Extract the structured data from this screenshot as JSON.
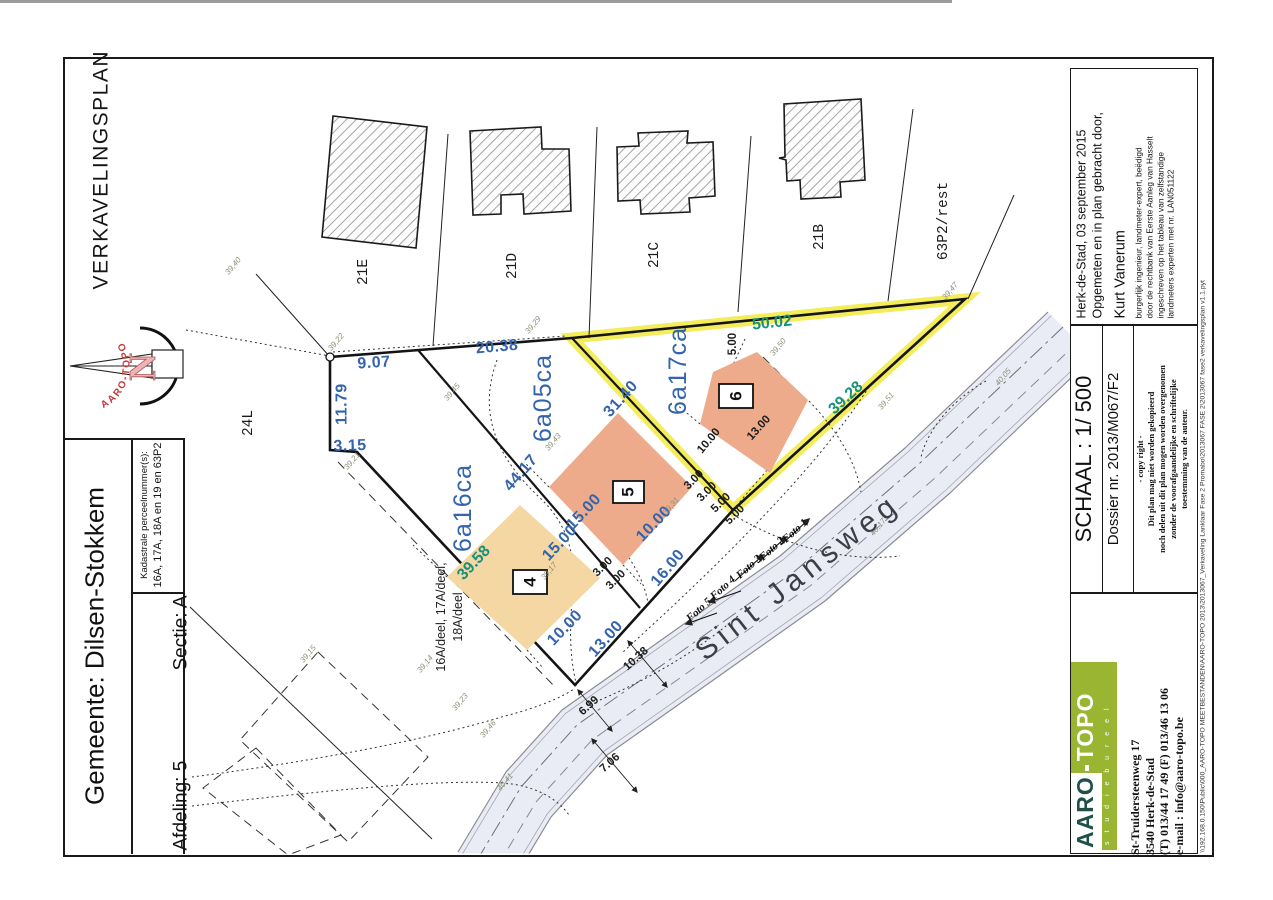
{
  "document": {
    "plan_type": "VERKAVELINGSPLAN",
    "file_path": "\\\\192.168.0.150\\Public\\000_AARO-TOPO MEETBESTANDEN\\AARO-TOPO 2013\\2013067_Verkaveling Lanklaar Fase 2 Promabo\\2013067 FASE 2\\2013067 fase2 verkavelingsplan v1.1.pyt"
  },
  "title_block": {
    "gemeente": "Gemeente: Dilsen-Stokkem",
    "afdeling": "Afdeling: 5",
    "sectie": "Sectie: A",
    "kadastrale_label": "Kadastrale perceelnummer(s):",
    "kadastrale_value": "16A, 17A, 18A en 19 en 63P2"
  },
  "survey_block": {
    "place_date": "Herk-de-Stad, 03 september 2015",
    "intro": "Opgemeten en in plan gebracht door,",
    "surveyor": "Kurt Vanerum",
    "credentials": [
      "burgerlijk ingenieur,  landmeter-expert,  beëdigd",
      "door de rechtbank van Eerste Aanleg van Hasselt",
      "ingeschreven op het tableau van zelfstandige",
      "landmeters experten met nr. LAN051122"
    ]
  },
  "scale_block": {
    "schaal": "SCHAAL : 1/ 500",
    "dossier": "Dossier nr. 2013/M067/F2",
    "copyright": [
      "- copy right -",
      "Dit plan mag niet worden gekopieerd",
      "noch delen uit dit plan mogen worden overgenomen",
      "zonder de voorafgaandelijke en schriftelijke",
      "toestemming van de auteur."
    ]
  },
  "firm_block": {
    "brand_left": "AARO",
    "brand_right": "TOPO",
    "brand_sub": "s t u d i e b u r e e l",
    "address": [
      "St-Truidersteenweg 17",
      "3540 Herk-de-Stad",
      "(T) 013/44 17 49  (F) 013/46 13 06",
      "e-mail : info@aaro-topo.be"
    ]
  },
  "compass": {
    "north": "N",
    "brand": "AARO-TOPO"
  },
  "colors": {
    "dim_blue": "#3465ac",
    "dim_teal": "#17917c",
    "lot_tan": "#f4d7a2",
    "lot_salmon": "#eeab8b",
    "highlight_yellow": "#f2ea3e",
    "road_fill": "#e9ecf5",
    "logo_green": "#9ab531",
    "logo_dark": "#20504a"
  },
  "plan": {
    "street_name": "Sint Jansweg",
    "lots": [
      {
        "nr": "4",
        "area": "6a16ca"
      },
      {
        "nr": "5",
        "area": "6a05ca"
      },
      {
        "nr": "6",
        "area": "6a17ca"
      }
    ],
    "neighbour_parcels": [
      "24L",
      "21E",
      "21D",
      "21C",
      "21B",
      "63P2/rest"
    ],
    "origin_parcels": "16A/deel, 17A/deel, 18A/deel",
    "labels": [
      {
        "t": "9.07",
        "x": 374,
        "y": 363,
        "r": -4,
        "k": "dim"
      },
      {
        "t": "20.38",
        "x": 497,
        "y": 347,
        "r": -5,
        "k": "dim"
      },
      {
        "t": "11.79",
        "x": 342,
        "y": 404,
        "r": -90,
        "k": "dim"
      },
      {
        "t": "3.15",
        "x": 350,
        "y": 446,
        "r": -2,
        "k": "dim"
      },
      {
        "t": "31.40",
        "x": 621,
        "y": 399,
        "r": -48,
        "k": "dim"
      },
      {
        "t": "44.17",
        "x": 521,
        "y": 473,
        "r": -49,
        "k": "dim"
      },
      {
        "t": "15.00",
        "x": 560,
        "y": 543,
        "r": -47,
        "k": "dim"
      },
      {
        "t": "10.00",
        "x": 565,
        "y": 628,
        "r": -46,
        "k": "dim"
      },
      {
        "t": "15.00",
        "x": 584,
        "y": 512,
        "r": -47,
        "k": "dim"
      },
      {
        "t": "10.00",
        "x": 654,
        "y": 524,
        "r": -46,
        "k": "dim"
      },
      {
        "t": "16.00",
        "x": 668,
        "y": 568,
        "r": -50,
        "k": "dim"
      },
      {
        "t": "13.00",
        "x": 606,
        "y": 639,
        "r": -48,
        "k": "dim"
      },
      {
        "t": "50.02",
        "x": 772,
        "y": 323,
        "r": -6,
        "k": "teal"
      },
      {
        "t": "39.28",
        "x": 846,
        "y": 398,
        "r": -43,
        "k": "teal"
      },
      {
        "t": "39.58",
        "x": 474,
        "y": 563,
        "r": -47,
        "k": "teal"
      },
      {
        "t": "3.00",
        "x": 603,
        "y": 567,
        "r": -45,
        "k": "dimk"
      },
      {
        "t": "3.00",
        "x": 616,
        "y": 580,
        "r": -45,
        "k": "dimk"
      },
      {
        "t": "3.00",
        "x": 694,
        "y": 480,
        "r": -45,
        "k": "dimk"
      },
      {
        "t": "3.00",
        "x": 707,
        "y": 492,
        "r": -45,
        "k": "dimk"
      },
      {
        "t": "5.00",
        "x": 721,
        "y": 503,
        "r": -45,
        "k": "dimk"
      },
      {
        "t": "5.00",
        "x": 735,
        "y": 515,
        "r": -45,
        "k": "dimk"
      },
      {
        "t": "5.00",
        "x": 733,
        "y": 344,
        "r": -90,
        "k": "dimk"
      },
      {
        "t": "10.00",
        "x": 709,
        "y": 441,
        "r": -50,
        "k": "dimk"
      },
      {
        "t": "13.00",
        "x": 759,
        "y": 428,
        "r": -48,
        "k": "dimk"
      },
      {
        "t": "10.38",
        "x": 636,
        "y": 659,
        "r": -42,
        "k": "dimk"
      },
      {
        "t": "6.99",
        "x": 589,
        "y": 706,
        "r": -42,
        "k": "dimk"
      },
      {
        "t": "7.06",
        "x": 610,
        "y": 763,
        "r": -42,
        "k": "dimk"
      },
      {
        "t": "6a16ca",
        "x": 463,
        "y": 508,
        "r": -90,
        "k": "area"
      },
      {
        "t": "6a05ca",
        "x": 543,
        "y": 398,
        "r": -90,
        "k": "area"
      },
      {
        "t": "6a17ca",
        "x": 678,
        "y": 371,
        "r": -90,
        "k": "area"
      },
      {
        "t": "24L",
        "x": 249,
        "y": 423,
        "r": -90,
        "k": "parcel"
      },
      {
        "t": "21E",
        "x": 364,
        "y": 272,
        "r": -90,
        "k": "parcel"
      },
      {
        "t": "21D",
        "x": 513,
        "y": 266,
        "r": -90,
        "k": "parcel"
      },
      {
        "t": "21C",
        "x": 655,
        "y": 255,
        "r": -90,
        "k": "parcel"
      },
      {
        "t": "21B",
        "x": 820,
        "y": 237,
        "r": -90,
        "k": "parcel"
      },
      {
        "t": "63P2/rest",
        "x": 944,
        "y": 221,
        "r": -90,
        "k": "parcel"
      },
      {
        "t": "16A/deel, 17A/deel,",
        "x": 441,
        "y": 617,
        "r": -90,
        "k": "deel"
      },
      {
        "t": "18A/deel",
        "x": 458,
        "y": 617,
        "r": -90,
        "k": "deel"
      },
      {
        "t": "4",
        "x": 530,
        "y": 582,
        "r": -90,
        "k": "lotnr"
      },
      {
        "t": "5",
        "x": 628,
        "y": 492,
        "r": -90,
        "k": "lotnr"
      },
      {
        "t": "6",
        "x": 736,
        "y": 396,
        "r": -90,
        "k": "lotnr"
      },
      {
        "t": "Foto 1",
        "x": 795,
        "y": 531,
        "r": -42,
        "k": "foto"
      },
      {
        "t": "Foto 2",
        "x": 772,
        "y": 549,
        "r": -42,
        "k": "foto"
      },
      {
        "t": "Foto 3",
        "x": 749,
        "y": 567,
        "r": -42,
        "k": "foto"
      },
      {
        "t": "Foto 4",
        "x": 723,
        "y": 588,
        "r": -42,
        "k": "foto"
      },
      {
        "t": "Foto 5",
        "x": 699,
        "y": 610,
        "r": -42,
        "k": "foto"
      },
      {
        "t": "39,40",
        "x": 233,
        "y": 266,
        "r": -50,
        "k": "elev"
      },
      {
        "t": "39,22",
        "x": 336,
        "y": 342,
        "r": -50,
        "k": "elev"
      },
      {
        "t": "39,45",
        "x": 452,
        "y": 392,
        "r": -50,
        "k": "elev"
      },
      {
        "t": "39,29",
        "x": 533,
        "y": 325,
        "r": -50,
        "k": "elev"
      },
      {
        "t": "39,21",
        "x": 352,
        "y": 461,
        "r": -50,
        "k": "elev"
      },
      {
        "t": "39,43",
        "x": 553,
        "y": 442,
        "r": -50,
        "k": "elev"
      },
      {
        "t": "39,31",
        "x": 671,
        "y": 506,
        "r": -50,
        "k": "elev"
      },
      {
        "t": "39,17",
        "x": 549,
        "y": 571,
        "r": -50,
        "k": "elev"
      },
      {
        "t": "39,50",
        "x": 778,
        "y": 347,
        "r": -50,
        "k": "elev"
      },
      {
        "t": "39,47",
        "x": 950,
        "y": 291,
        "r": -50,
        "k": "elev"
      },
      {
        "t": "39,51",
        "x": 886,
        "y": 401,
        "r": -50,
        "k": "elev"
      },
      {
        "t": "39,23",
        "x": 460,
        "y": 702,
        "r": -50,
        "k": "elev"
      },
      {
        "t": "39,14",
        "x": 425,
        "y": 664,
        "r": -50,
        "k": "elev"
      },
      {
        "t": "39,15",
        "x": 308,
        "y": 654,
        "r": -50,
        "k": "elev"
      },
      {
        "t": "39,46",
        "x": 488,
        "y": 729,
        "r": -50,
        "k": "elev"
      },
      {
        "t": "40,41",
        "x": 505,
        "y": 782,
        "r": -50,
        "k": "elev"
      },
      {
        "t": "40,05",
        "x": 1003,
        "y": 377,
        "r": -50,
        "k": "elev"
      },
      {
        "t": "40,17",
        "x": 878,
        "y": 527,
        "r": -50,
        "k": "elev"
      },
      {
        "t": "Sint  Jansweg",
        "x": 798,
        "y": 577,
        "r": -38,
        "k": "street"
      }
    ]
  }
}
